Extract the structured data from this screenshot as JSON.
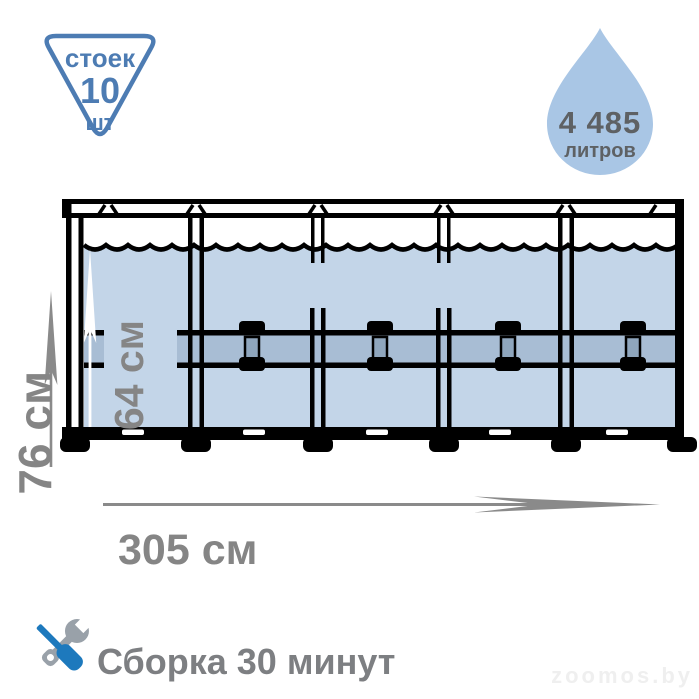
{
  "badge": {
    "line1": "стоек",
    "line2": "10",
    "line3": "шт"
  },
  "volume": {
    "value": "4 485",
    "unit": "литров"
  },
  "dimensions": {
    "total_height": "76 см",
    "water_height": "64 см",
    "length": "305 см"
  },
  "assembly": {
    "label": "Сборка 30 минут"
  },
  "watermark": {
    "text": "zoomos.by"
  },
  "icons": {
    "badge_shape": "inverted-triangle-badge",
    "volume_shape": "water-drop-icon",
    "assembly_icon": "screwdriver-wrench-icon",
    "diagram": "frame-pool-side-view"
  },
  "colors": {
    "accent_blue": "#4d7cb3",
    "water": "#c3d5e8",
    "frame_band": "#a8bdd4",
    "connector_gray": "#8fa6bd",
    "drop_blue": "#a9c6e5",
    "label_gray": "#858585",
    "dark_text": "#5e6164",
    "screwdriver_blue": "#1d79bd",
    "wrench_gray": "#99a1a9",
    "outline_black": "#000000"
  }
}
